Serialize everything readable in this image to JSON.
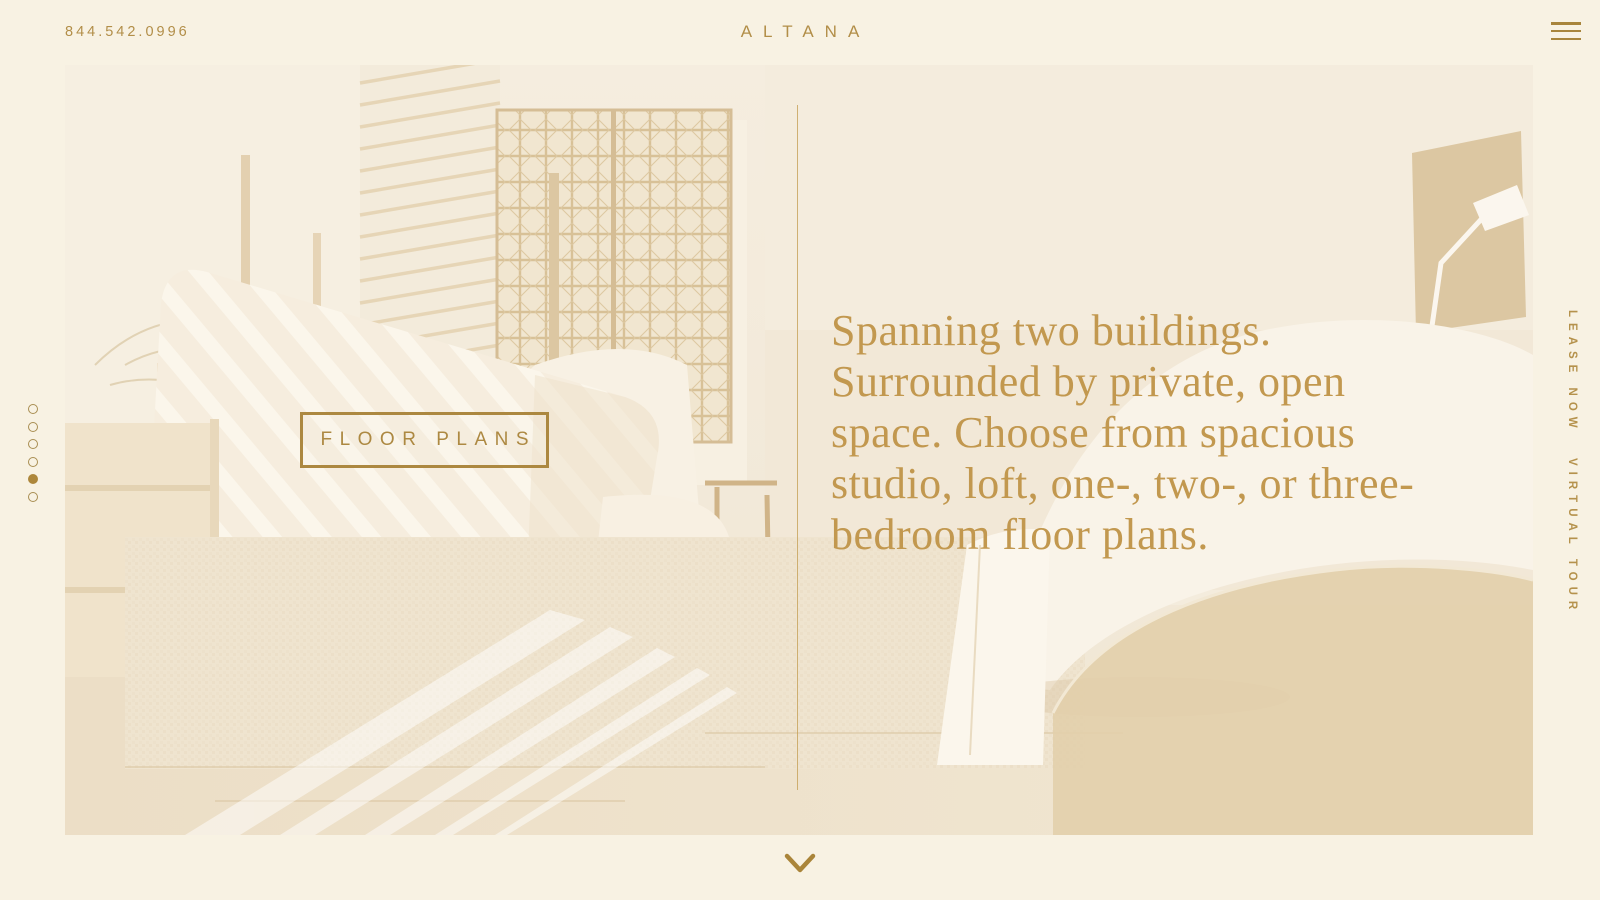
{
  "header": {
    "phone": "844.542.0996",
    "logo": "ALTANA",
    "menu_icon": "hamburger-icon"
  },
  "carousel": {
    "dot_count": 6,
    "active_index": 4
  },
  "hero": {
    "button_label": "FLOOR PLANS",
    "headline_lines": [
      "Spanning two buildings.",
      "Surrounded by private, open",
      "space. Choose from spacious",
      "studio, loft, one-, two-, or three-",
      "bedroom floor plans."
    ],
    "photo_description": "sepia-washed bedroom with striped armchair, lattice screen, bed and floor lamp"
  },
  "side_nav": {
    "lease_now": "LEASE NOW",
    "virtual_tour": "VIRTUAL TOUR"
  },
  "footer": {
    "scroll_icon": "chevron-down-icon"
  },
  "colors": {
    "page_bg": "#f8f2e3",
    "accent_gold": "#b28e48",
    "headline_gold": "#c2984f",
    "button_gold": "#ac8840",
    "photo_tint": "#f2e9da"
  }
}
